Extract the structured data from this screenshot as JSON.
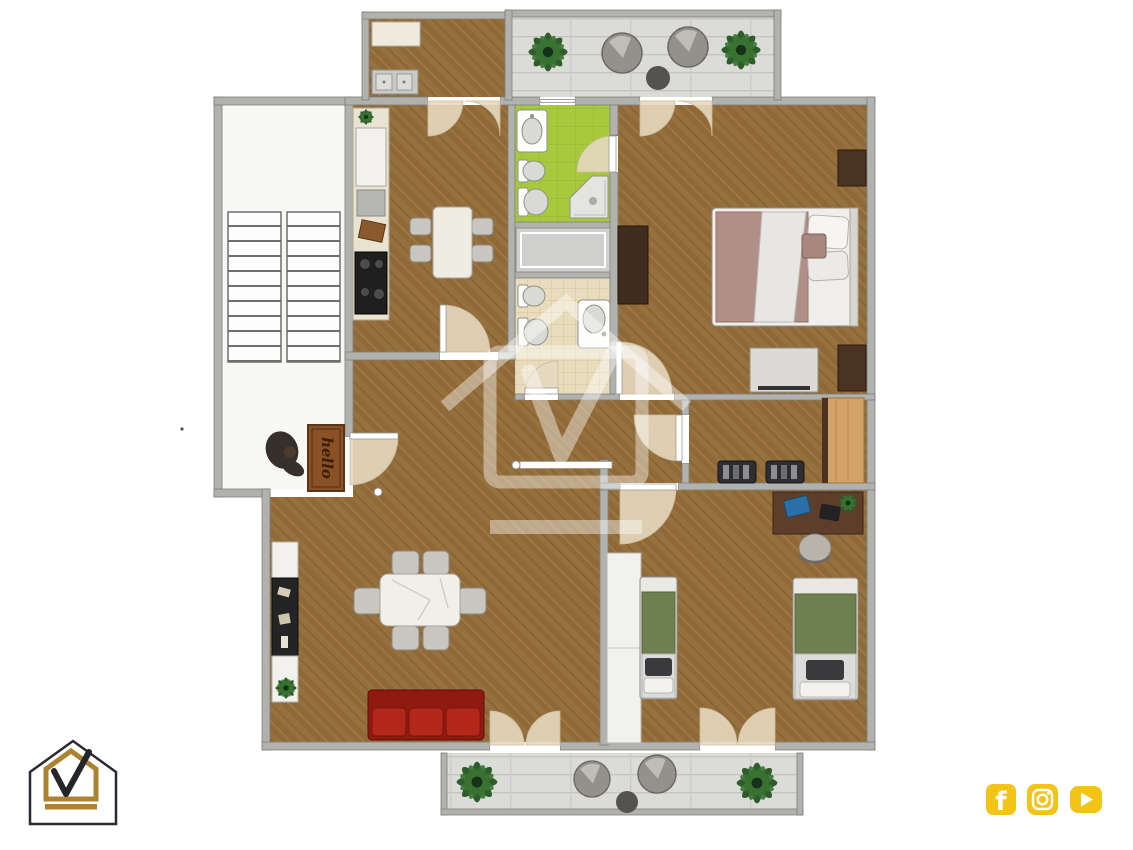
{
  "page": {
    "background": "#ffffff",
    "kind": "3d-rendered-apartment-floor-plan"
  },
  "floor_plan": {
    "watermark": {
      "name": "house-checkmark-watermark",
      "color": "#ffffff",
      "opacity": 0.42
    },
    "entry_mat": {
      "text": "hello",
      "color": "#8a5126"
    },
    "palette": {
      "wood_floor": "#8f6937",
      "wall": "#b1b1ae",
      "bathroom_green": "#a6c93e",
      "bathroom_tile_beige": "#e9dcbc",
      "terrace_tile": "#dbdbd7",
      "stairwell_floor": "#f7f7f5",
      "sofa_red": "#a82014",
      "bed_green": "#6e7f50",
      "bed_mauve": "#b09086",
      "desk_wood": "#5c3e2a",
      "wardrobe_tan": "#d3a268"
    },
    "rooms": [
      "stairwell",
      "utility-balcony",
      "terrace",
      "kitchen",
      "green-bathroom",
      "second-bathroom",
      "master-bedroom",
      "hallway",
      "dressing-corridor",
      "living-dining-room",
      "twin-bedroom",
      "rear-balcony"
    ],
    "furniture": [
      "staircase",
      "kitchen-counter",
      "cooktop",
      "kitchen-sink",
      "kitchen-table-4-chairs",
      "dining-table-6-chairs",
      "red-sofa",
      "sideboard",
      "double-bed",
      "nightstands",
      "tv-dresser",
      "wardrobes",
      "single-bed-left",
      "single-bed-right",
      "desk-with-laptop",
      "desk-chair",
      "shoe-benches",
      "toilets",
      "bidets",
      "washbasins",
      "corner-shower",
      "potted-plants",
      "round-lounge-chairs",
      "side-tables",
      "hello-doormat"
    ]
  },
  "branding": {
    "logo": {
      "name": "house-checkmark-logo",
      "outline": "#2b2a33",
      "accent": "#ac8431"
    },
    "social": {
      "color": "#f2c417",
      "icons": [
        "facebook",
        "instagram",
        "youtube"
      ]
    }
  }
}
